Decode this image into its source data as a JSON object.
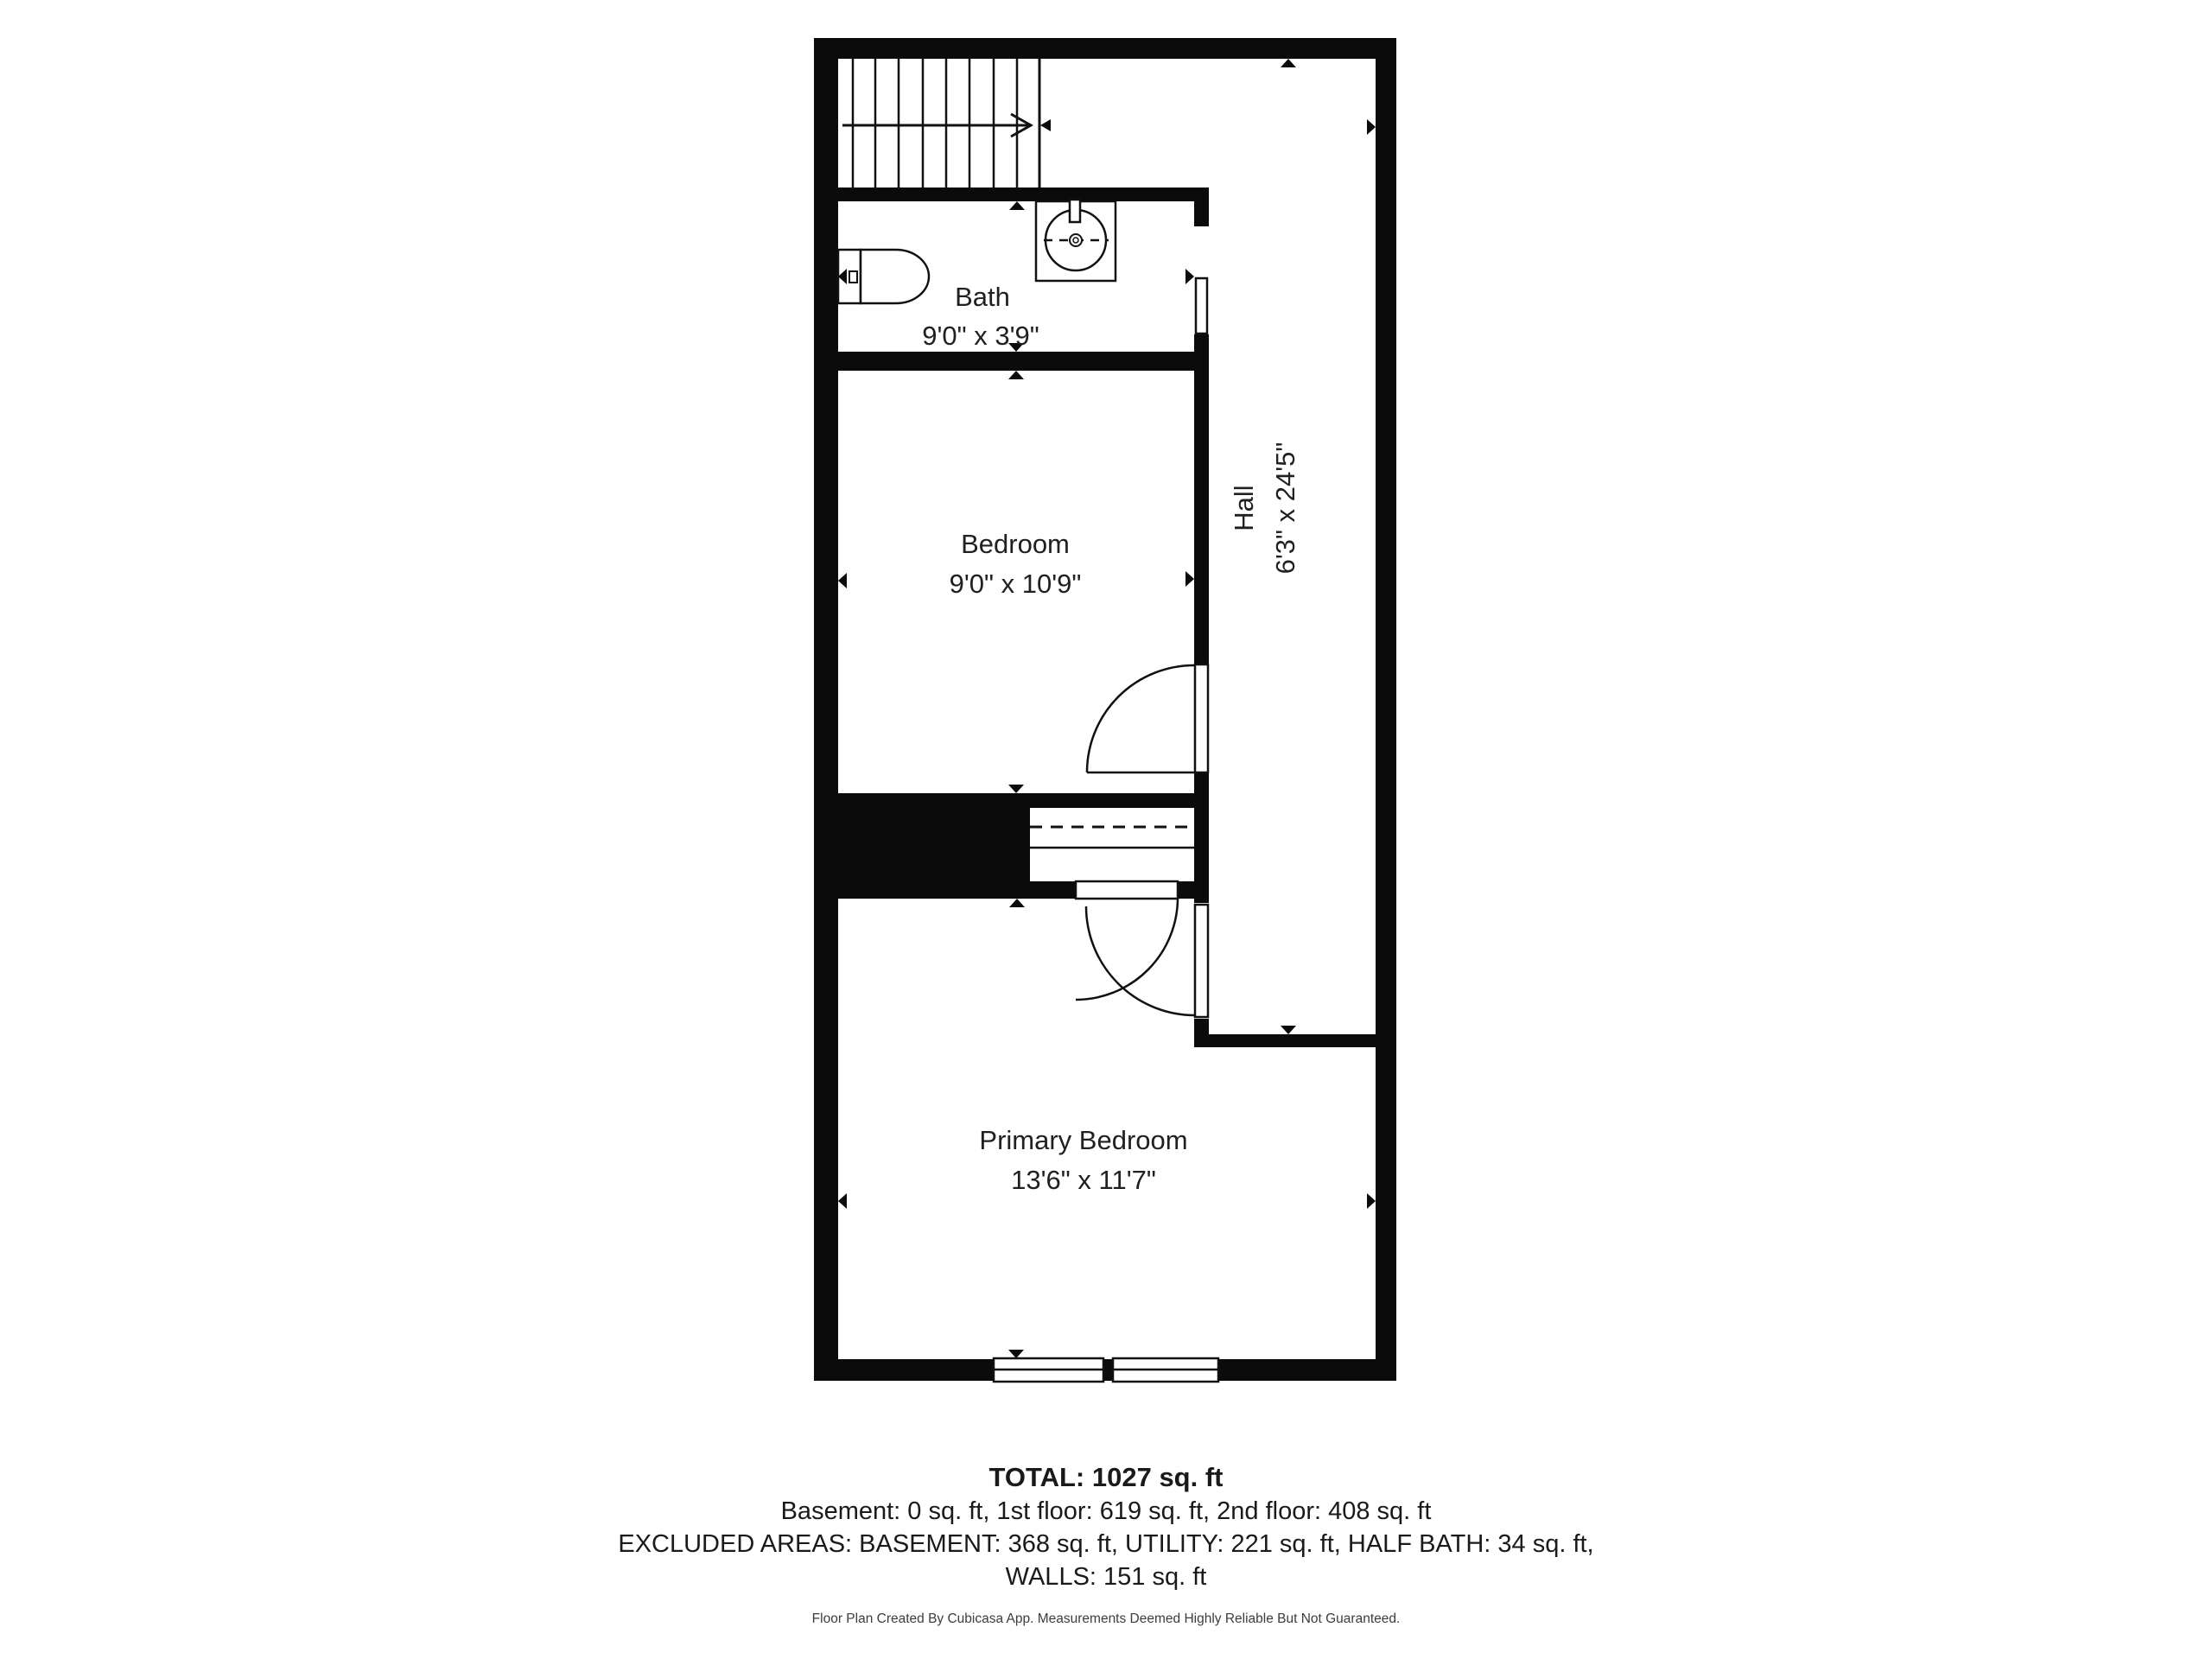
{
  "rooms": {
    "bath": {
      "name": "Bath",
      "dimensions": "9'0\" x 3'9\""
    },
    "bedroom": {
      "name": "Bedroom",
      "dimensions": "9'0\" x 10'9\""
    },
    "hall": {
      "name": "Hall",
      "dimensions": "6'3\" x 24'5\""
    },
    "primary_bedroom": {
      "name": "Primary Bedroom",
      "dimensions": "13'6\" x 11'7\""
    }
  },
  "summary": {
    "total": "TOTAL: 1027 sq. ft",
    "floors": "Basement: 0 sq. ft, 1st floor: 619 sq. ft, 2nd floor: 408 sq. ft",
    "excluded_line1": "EXCLUDED AREAS: BASEMENT: 368 sq. ft, UTILITY: 221 sq. ft, HALF BATH: 34 sq. ft,",
    "excluded_line2": "WALLS: 151 sq. ft"
  },
  "footer": {
    "credit": "Floor Plan Created By Cubicasa App. Measurements Deemed Highly Reliable But Not Guaranteed."
  },
  "colors": {
    "wall": "#0b0b0b",
    "text": "#202020",
    "background": "#ffffff"
  }
}
